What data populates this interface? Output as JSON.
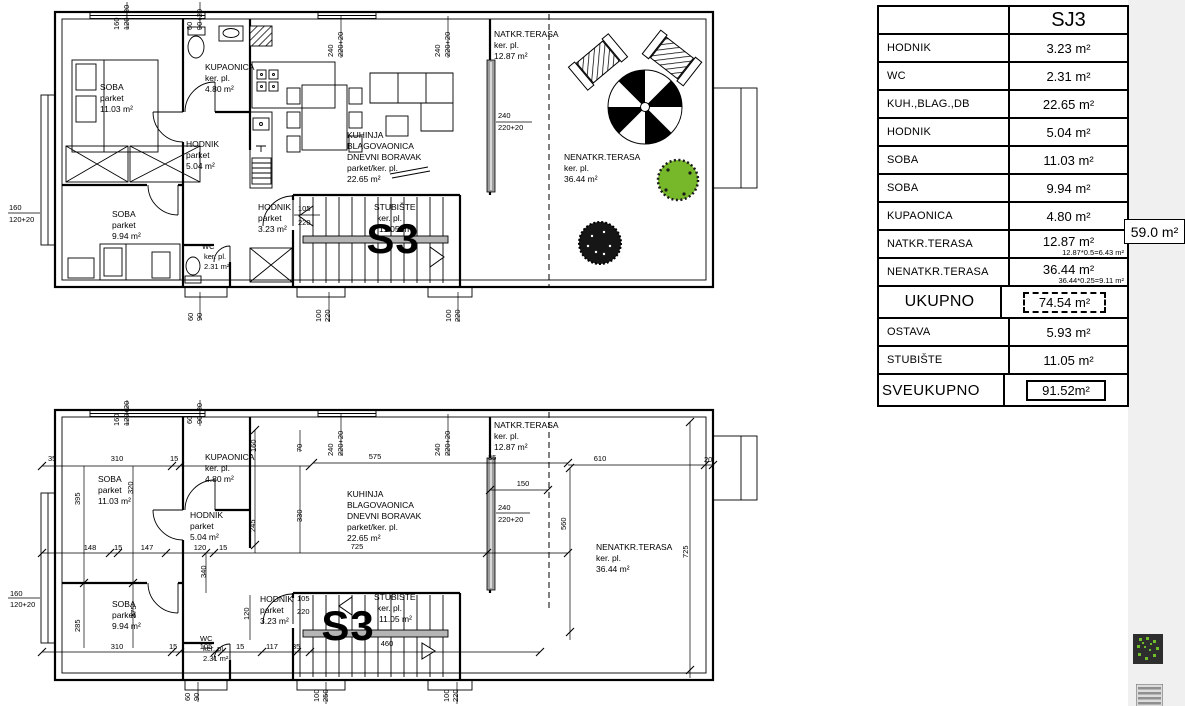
{
  "table": {
    "header": {
      "value": "SJ3"
    },
    "rows": [
      {
        "label": "HODNIK",
        "value": "3.23 m²"
      },
      {
        "label": "WC",
        "value": "2.31 m²"
      },
      {
        "label": "KUH.,BLAG.,DB",
        "value": "22.65 m²"
      },
      {
        "label": "HODNIK",
        "value": "5.04 m²"
      },
      {
        "label": "SOBA",
        "value": "11.03 m²"
      },
      {
        "label": "SOBA",
        "value": "9.94 m²"
      },
      {
        "label": "KUPAONICA",
        "value": "4.80 m²"
      },
      {
        "label": "NATKR.TERASA",
        "value": "12.87 m²",
        "note": "12.87*0.5=6.43 m²"
      },
      {
        "label": "NENATKR.TERASA",
        "value": "36.44 m²",
        "note": "36.44*0.25=9.11 m²"
      },
      {
        "label": "UKUPNO",
        "value": "74.54 m²"
      },
      {
        "label": "OSTAVA",
        "value": "5.93 m²"
      },
      {
        "label": "STUBIŠTE",
        "value": "11.05 m²"
      },
      {
        "label": "SVEUKUPNO",
        "value": "91.52m²"
      }
    ],
    "side_badge": "59.0 m²"
  },
  "plan": {
    "unit": "S3",
    "rooms": {
      "soba1": {
        "name": "SOBA",
        "floor": "parket",
        "area": "11.03 m²"
      },
      "soba2": {
        "name": "SOBA",
        "floor": "parket",
        "area": "9.94 m²"
      },
      "kupaonica": {
        "name": "KUPAONICA",
        "floor": "ker. pl.",
        "area": "4.80 m²"
      },
      "hodnik1": {
        "name": "HODNIK",
        "floor": "parket",
        "area": "5.04 m²"
      },
      "hodnik2": {
        "name": "HODNIK",
        "floor": "parket",
        "area": "3.23 m²"
      },
      "wc": {
        "name": "WC",
        "floor": "ker. pl.",
        "area": "2.31 m²"
      },
      "kuhinja": {
        "name1": "KUHINJA",
        "name2": "BLAGOVAONICA",
        "name3": "DNEVNI BORAVAK",
        "floor": "parket/ker. pl.",
        "area": "22.65 m²"
      },
      "natkr": {
        "name": "NATKR.TERASA",
        "floor": "ker. pl.",
        "area": "12.87 m²"
      },
      "nenatkr": {
        "name": "NENATKR.TERASA",
        "floor": "ker. pl.",
        "area": "36.44 m²"
      },
      "stubiste": {
        "name": "STUBIŠTE",
        "floor": "ker. pl.",
        "area": "11.05 m²"
      }
    },
    "dims1": [
      "160",
      "120+20",
      "60",
      "90+20",
      "240",
      "220+20",
      "240",
      "220+20",
      "240",
      "220+20",
      "105",
      "220",
      "160",
      "120+20",
      "60",
      "90",
      "100",
      "220",
      "100",
      "220"
    ],
    "dims2": [
      "160",
      "120+20",
      "60",
      "90+20",
      "70",
      "240",
      "220+20",
      "240",
      "220+20",
      "575",
      "35",
      "610",
      "20",
      "35",
      "310",
      "15",
      "160",
      "320",
      "395",
      "330",
      "245",
      "148",
      "15",
      "147",
      "120",
      "15",
      "340",
      "725",
      "150",
      "240",
      "220+20",
      "560",
      "725",
      "160",
      "120+20",
      "285",
      "375",
      "310",
      "15",
      "105",
      "15",
      "117",
      "35",
      "105",
      "220",
      "460",
      "100",
      "250",
      "100",
      "220",
      "60",
      "90",
      "120"
    ]
  },
  "icons": {
    "plant_bg": "#2e2e2e",
    "plant_green": "#6fbf2a",
    "stairs_gray": "#8f8f8f",
    "tree_green": "#76b82a"
  }
}
